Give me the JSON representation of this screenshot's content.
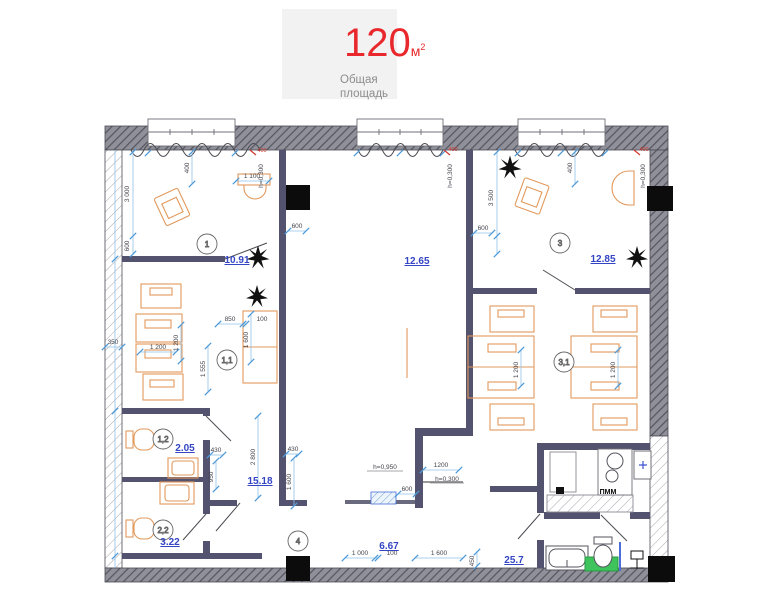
{
  "header": {
    "value": "120",
    "unit": "м",
    "unit_sup": "2",
    "caption1": "Общая",
    "caption2": "площадь"
  },
  "rooms": {
    "r1": "1",
    "r11": "1,1",
    "r12": "1,2",
    "r22": "2,2",
    "r3": "3",
    "r31": "3,1",
    "r4": "4"
  },
  "areas": {
    "r1": "10.91",
    "center": "12.65",
    "r3": "12.85",
    "r12": "2.05",
    "r22": "3.22",
    "corridor": "15.18",
    "r4": "6.67",
    "hall": "25.7"
  },
  "dims": {
    "w1_400": "400",
    "r1_3000": "3 000",
    "r1_600": "600",
    "r1_1100": "1 100",
    "red1": "400",
    "h1": "h=0,300",
    "c_600": "600",
    "red2": "400",
    "h2": "h=0,300",
    "r3_3500": "3 500",
    "r3_600": "600",
    "r3_400": "400",
    "red3": "400",
    "h3": "h=0,300",
    "lw_350": "350",
    "r11_1200a": "1 200",
    "r11_1200b": "1 200",
    "r11_1555": "1 555",
    "r11_850": "850",
    "r11_100": "100",
    "r11_1600": "1 600",
    "cor_2800": "2 800",
    "cor_430a": "430",
    "cor_950": "950",
    "cor_430b": "430",
    "cor_1600": "1 600",
    "r31_1200a": "1 200",
    "r31_1200b": "1 200",
    "b_h950": "h=0,950",
    "b_1200": "1200",
    "b_h300": "h=0,300",
    "b_600": "600",
    "b_1000": "1 000",
    "b_100": "100",
    "b_1600": "1 600",
    "b_450": "450"
  },
  "kitchen": {
    "pmm": "ПММ"
  }
}
